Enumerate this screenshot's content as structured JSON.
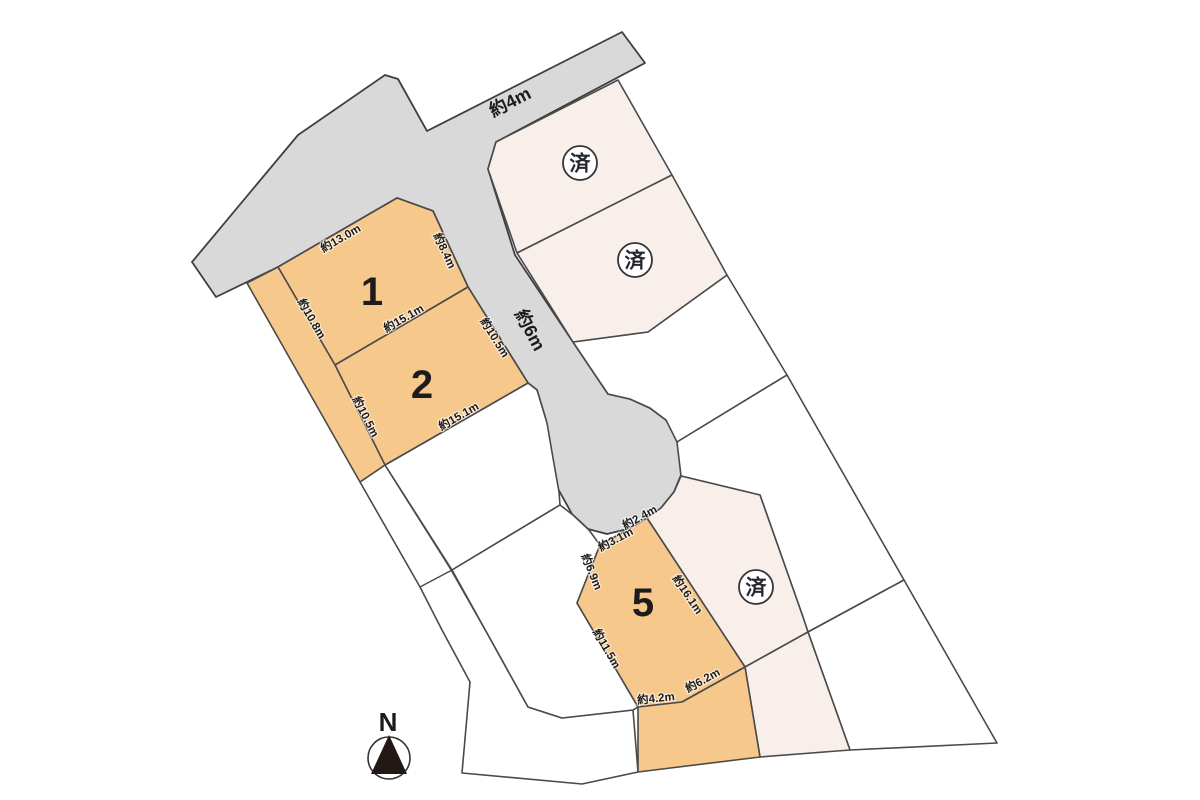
{
  "roads": {
    "north": {
      "label": "約4m"
    },
    "center": {
      "label": "約6m"
    }
  },
  "plots": {
    "plot1": {
      "number": "1",
      "dim_top": "約13.0m",
      "dim_ne": "約8.4m",
      "dim_s": "約15.1m",
      "dim_w": "約10.8m"
    },
    "plot2": {
      "number": "2",
      "dim_e": "約10.5m",
      "dim_s": "約15.1m",
      "dim_w": "約10.5m"
    },
    "plot5": {
      "number": "5",
      "dim_road": "約2.4m",
      "dim_nw": "約3.1m",
      "dim_w": "約6.9m",
      "dim_e": "約16.1m",
      "dim_sw": "約11.5m",
      "dim_s": "約4.2m",
      "dim_se": "約6.2m"
    },
    "sold_north": {
      "status": "済"
    },
    "sold_middle": {
      "status": "済"
    },
    "sold_south": {
      "status": "済"
    }
  },
  "compass": {
    "north_label": "N"
  },
  "colors": {
    "available_plot": "#f7c88b",
    "sold_plot": "#f8efeb",
    "road": "#d9d9da",
    "white_parcel": "#ffffff",
    "compass_north": "#2b3990",
    "compass_needle": "#231815"
  }
}
